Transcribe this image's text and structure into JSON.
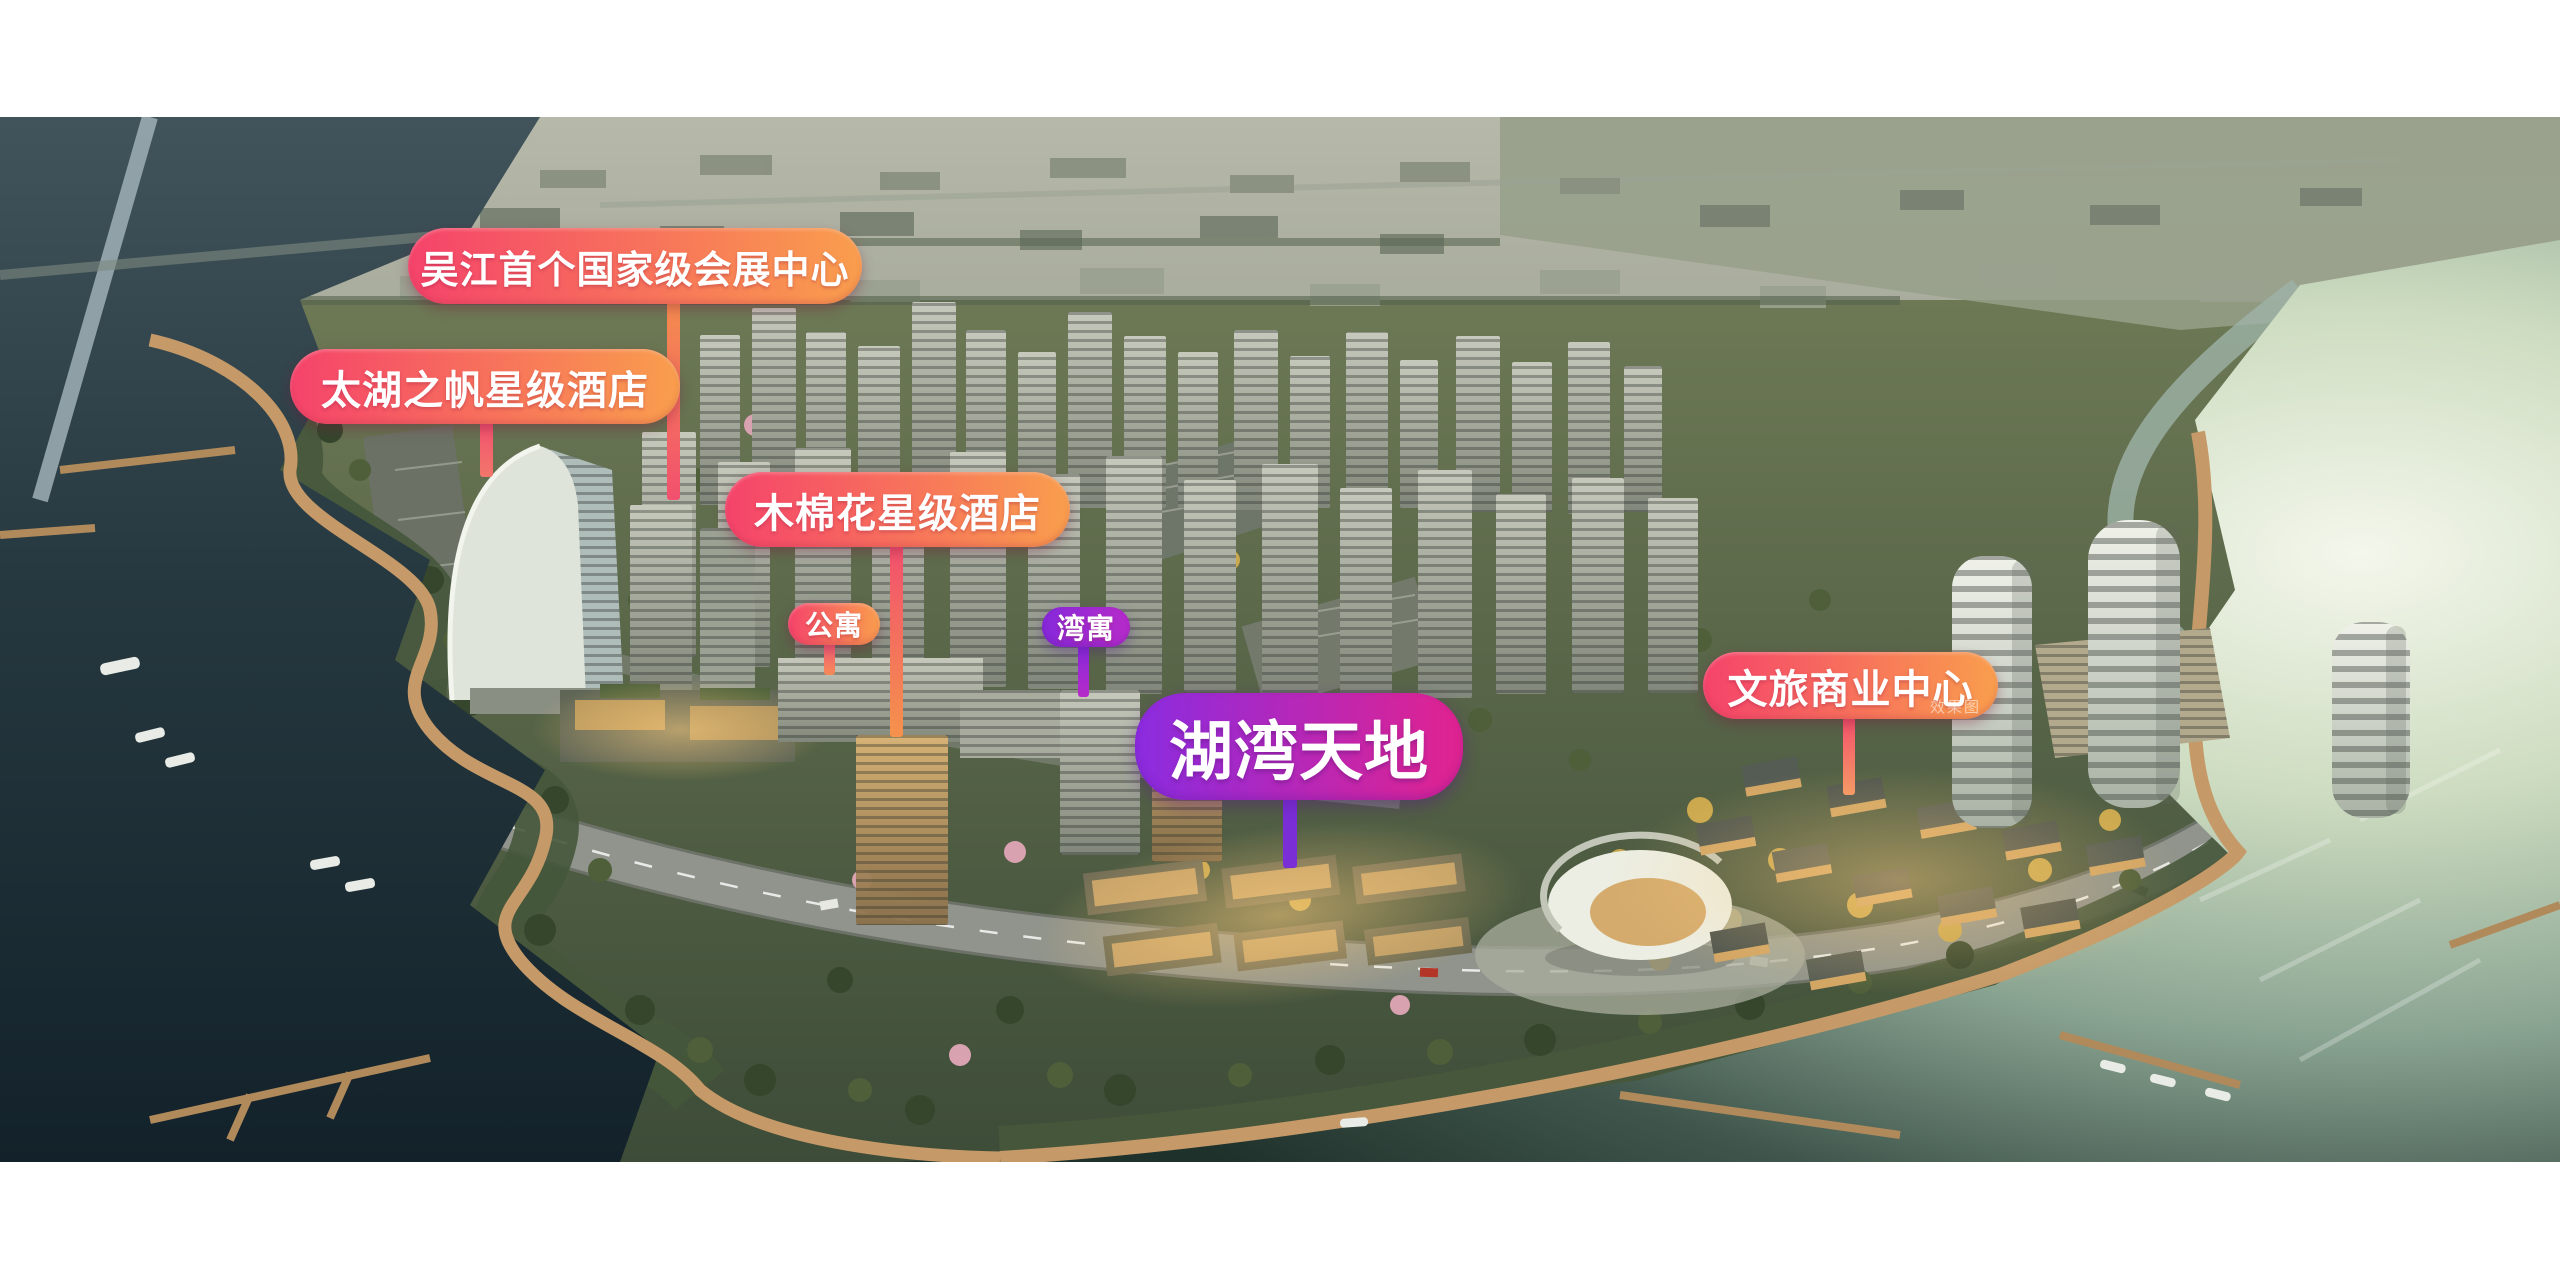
{
  "labels": {
    "convention": {
      "text": "吴江首个国家级会展中心"
    },
    "taihu_hotel": {
      "text": "太湖之帆星级酒店"
    },
    "kapok_hotel": {
      "text": "木棉花星级酒店"
    },
    "apartment": {
      "text": "公寓"
    },
    "bay_apartment": {
      "text": "湾寓"
    },
    "huwan_tiandi": {
      "text": "湖湾天地"
    },
    "cultural_commercial_center": {
      "text": "文旅商业中心"
    },
    "watermark": {
      "text": "效果图"
    }
  },
  "colors": {
    "pill_from": "#f5436b",
    "pill_to": "#f99e4d",
    "grand_from": "#8b2ce0",
    "grand_to": "#e1238f",
    "violet_from": "#8629da",
    "violet_to": "#b62bc9",
    "line_pink": "#f2506e",
    "line_orange": "#f5924c",
    "line_purple": "#7a2fd6",
    "label_text": "#ffffff"
  }
}
